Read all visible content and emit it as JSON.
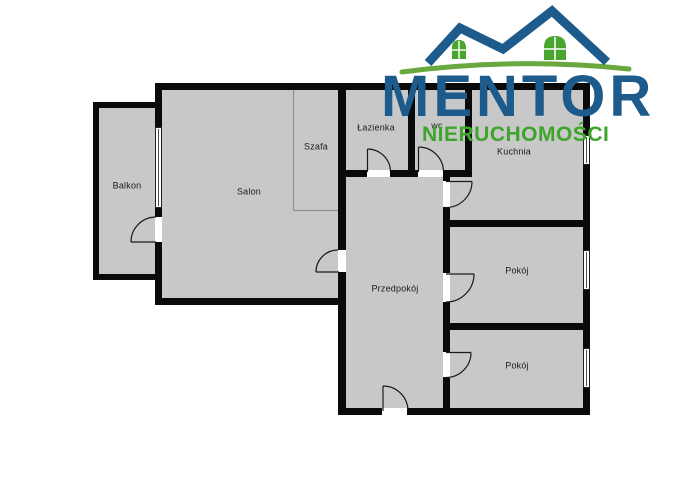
{
  "logo": {
    "brand": "MENTOR",
    "tagline": "NIERUCHOMOŚCI",
    "brand_color": "#1d5b8c",
    "tagline_color": "#3ea52c",
    "roof_color": "#1d5b8c",
    "window_color": "#4aa52e",
    "swoosh_color": "#68a83e"
  },
  "floorplan": {
    "wall_color": "#0a0a0a",
    "floor_color": "#c8c8c8",
    "labels": {
      "balkon": "Balkon",
      "salon": "Salon",
      "szafa": "Szafa",
      "lazienka": "Łazienka",
      "wc": "wc",
      "kuchnia": "Kuchnia",
      "przedpokoj": "Przedpokój",
      "pokoj1": "Pokój",
      "pokoj2": "Pokój"
    }
  }
}
